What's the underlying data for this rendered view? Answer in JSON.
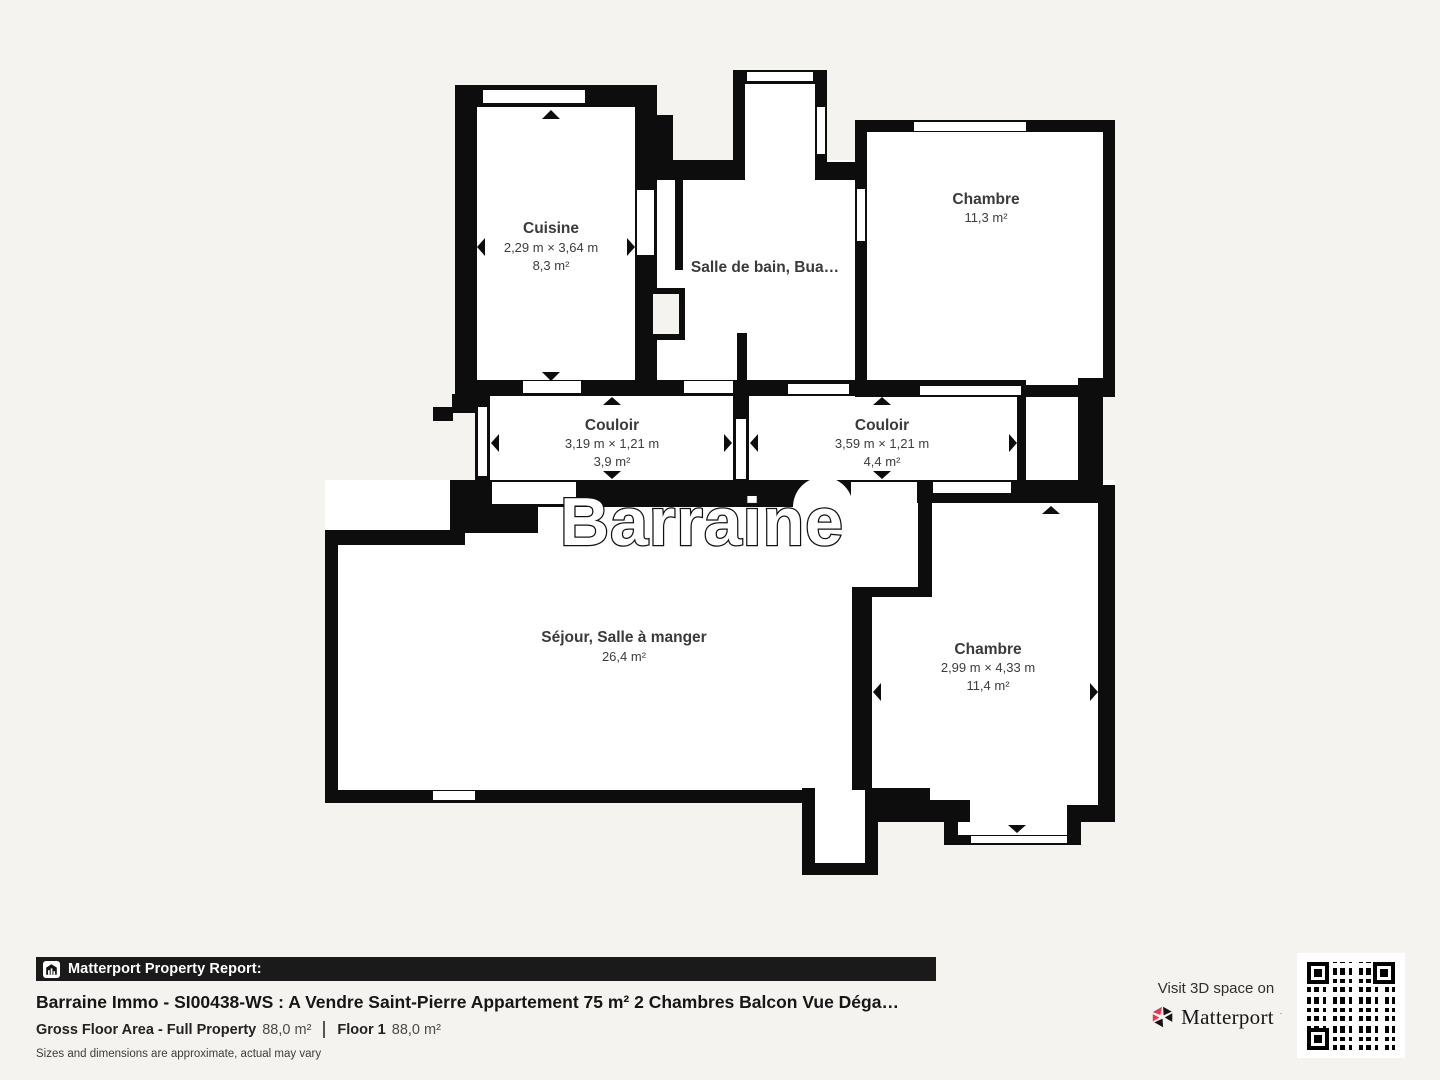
{
  "plan": {
    "watermark": "Barraine",
    "rooms": [
      {
        "id": "cuisine",
        "name": "Cuisine",
        "dims": "2,29 m × 3,64 m",
        "area": "8,3 m²"
      },
      {
        "id": "salle-de-bain",
        "name": "Salle de bain, Bua…"
      },
      {
        "id": "chambre-haut",
        "name": "Chambre",
        "area": "11,3 m²"
      },
      {
        "id": "couloir-1",
        "name": "Couloir",
        "dims": "3,19 m × 1,21 m",
        "area": "3,9 m²"
      },
      {
        "id": "couloir-2",
        "name": "Couloir",
        "dims": "3,59 m × 1,21 m",
        "area": "4,4 m²"
      },
      {
        "id": "sejour",
        "name": "Séjour, Salle à manger",
        "area": "26,4 m²"
      },
      {
        "id": "chambre-bas",
        "name": "Chambre",
        "dims": "2,99 m × 4,33 m",
        "area": "11,4 m²"
      }
    ]
  },
  "footer": {
    "report_label": "Matterport Property Report:",
    "title": "Barraine Immo - SI00438-WS : A Vendre Saint-Pierre Appartement 75 m² 2 Chambres Balcon Vue Déga…",
    "gfa_label": "Gross Floor Area - Full Property",
    "gfa_value": "88,0 m²",
    "floor_label": "Floor 1",
    "floor_value": "88,0 m²",
    "disclaimer": "Sizes and dimensions are approximate, actual may vary",
    "visit_text": "Visit 3D space on",
    "brand": "Matterport"
  },
  "colors": {
    "background": "#f4f3f0",
    "wall": "#0d0d0d",
    "room_floor": "#ffffff",
    "label_text": "#3a3a3a",
    "banner_bg": "#1a1a1a",
    "brand_red": "#ee3352"
  }
}
